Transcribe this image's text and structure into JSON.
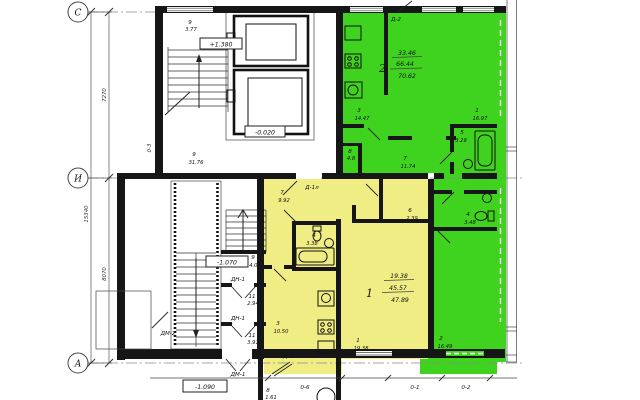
{
  "drawing": {
    "axes": {
      "c": "С",
      "i": "И",
      "a": "А",
      "col3": "0-3",
      "col6": "0-6",
      "col1": "0-1",
      "col2": "0-2"
    },
    "dims": {
      "total": "15340",
      "upper": "7270",
      "lower": "8070"
    },
    "levels": {
      "l1380": "+1.380",
      "l020": "-0.020",
      "l1070": "-1.070",
      "l1090": "-1.090"
    },
    "doors": {
      "d2top": "Д-2",
      "d1l": "Д-1л",
      "d2bottom": "Д-2",
      "dn1a": "ДН-1",
      "dn1b": "ДН-1",
      "dm1": "ДМ-1",
      "dm2": "ДМ-2"
    },
    "apt1": {
      "num": "1",
      "living": "19.38",
      "total": "45.57",
      "full": "47.89",
      "rooms": {
        "hall": {
          "n": "7",
          "a": "9.92"
        },
        "bath": {
          "n": "4",
          "a": "3.38"
        },
        "closet": {
          "n": "6",
          "a": "2.39"
        },
        "kitchen": {
          "n": "3",
          "a": "10.50"
        },
        "living": {
          "n": "1",
          "a": "19.38"
        }
      }
    },
    "apt2": {
      "num": "2",
      "living": "33.46",
      "total": "66.44",
      "full": "70.62",
      "rooms": {
        "kitchen": {
          "n": "3",
          "a": "14.47"
        },
        "living": {
          "n": "1",
          "a": "16.97"
        },
        "bath": {
          "n": "5",
          "a": "3.29"
        },
        "hall": {
          "n": "7",
          "a": "11.74"
        },
        "storage": {
          "n": "8",
          "a": "4.8"
        },
        "wc": {
          "n": "4",
          "a": "3.48"
        },
        "bedroom": {
          "n": "2",
          "a": "16.49"
        }
      }
    },
    "common": {
      "balcony": {
        "n": "9",
        "a": "3.77"
      },
      "corridor": {
        "n": "9",
        "a": "31.76"
      },
      "landing": {
        "n": "9",
        "a": "4.07"
      },
      "lobby1": {
        "n": "11",
        "a": "2.94"
      },
      "lobby2": {
        "n": "11",
        "a": "3.91"
      },
      "entry": {
        "n": "8",
        "a": "1.61"
      }
    }
  },
  "colors": {
    "apt1": "#f1ed85",
    "apt2": "#3fd31f",
    "wall": "#161616"
  }
}
